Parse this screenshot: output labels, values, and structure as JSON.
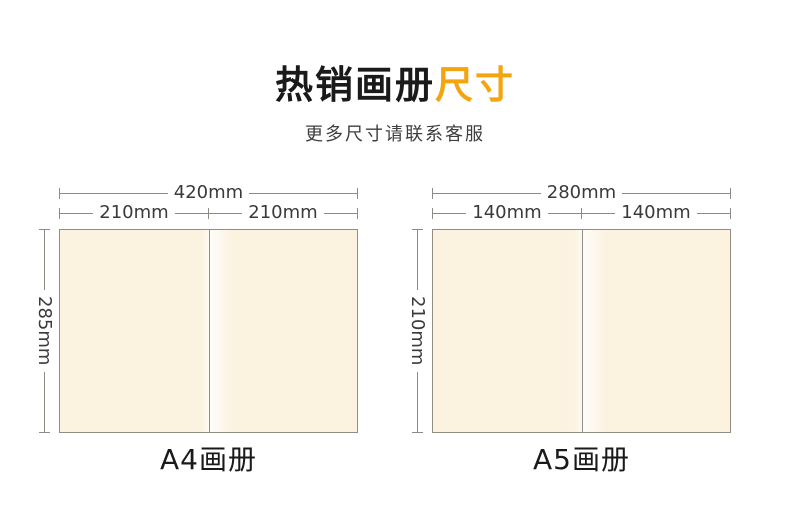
{
  "header": {
    "title_main": "热销画册",
    "title_accent": "尺寸",
    "subtitle": "更多尺寸请联系客服"
  },
  "diagrams": [
    {
      "id": "a4-booklet",
      "total_width": "420mm",
      "left_width": "210mm",
      "right_width": "210mm",
      "height": "285mm",
      "caption": "A4画册"
    },
    {
      "id": "a5-booklet",
      "total_width": "280mm",
      "left_width": "140mm",
      "right_width": "140mm",
      "height": "210mm",
      "caption": "A5画册"
    }
  ],
  "colors": {
    "accent": "#F2A50F",
    "title_text": "#1A1A1A",
    "subtitle_text": "#3E3E3E",
    "dim_line": "#8C8C84",
    "dim_text": "#3A3A3A",
    "paper_fill": "#FCF2E0",
    "paper_border": "#908E84"
  }
}
